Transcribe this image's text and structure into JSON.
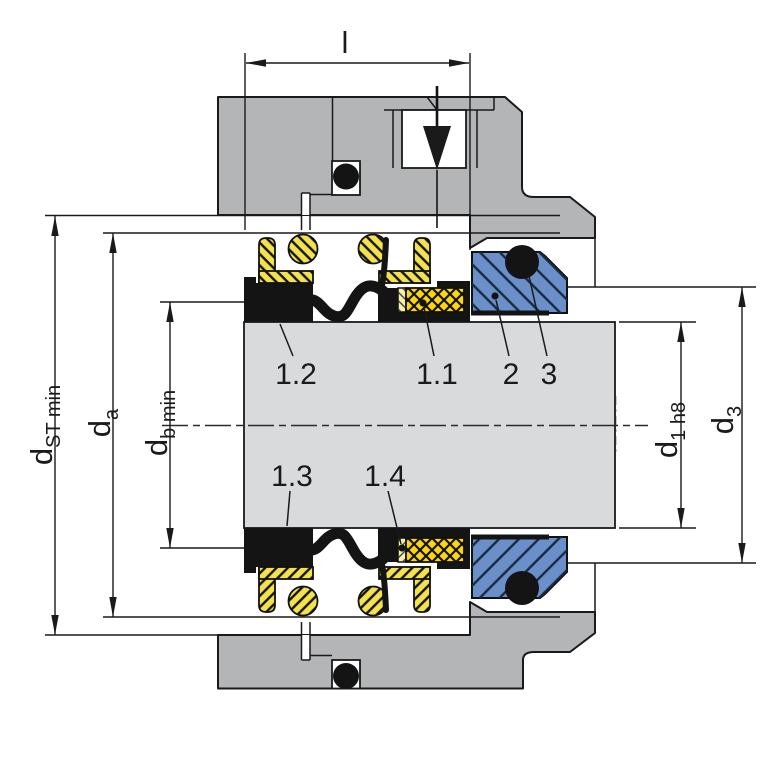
{
  "diagram": {
    "dimension_labels": {
      "length": "l",
      "d_st": {
        "base": "d",
        "sub": "ST min"
      },
      "d_a": {
        "base": "d",
        "sub": "a"
      },
      "d_b": {
        "base": "d",
        "sub": "b min"
      },
      "d_1": {
        "base": "d",
        "sub": "1 h8"
      },
      "d_3": {
        "base": "d",
        "sub": "3"
      }
    },
    "part_labels": {
      "p1_1": "1.1",
      "p1_2": "1.2",
      "p1_3": "1.3",
      "p1_4": "1.4",
      "p2": "2",
      "p3": "3"
    },
    "colors": {
      "housing": "#b3b5b7",
      "shaft": "#d9dadc",
      "spring": "#f3e14d",
      "gold": "#fdd605",
      "pale": "#f6f0a9",
      "seat": "#6b8fc9",
      "black": "#141414"
    }
  }
}
